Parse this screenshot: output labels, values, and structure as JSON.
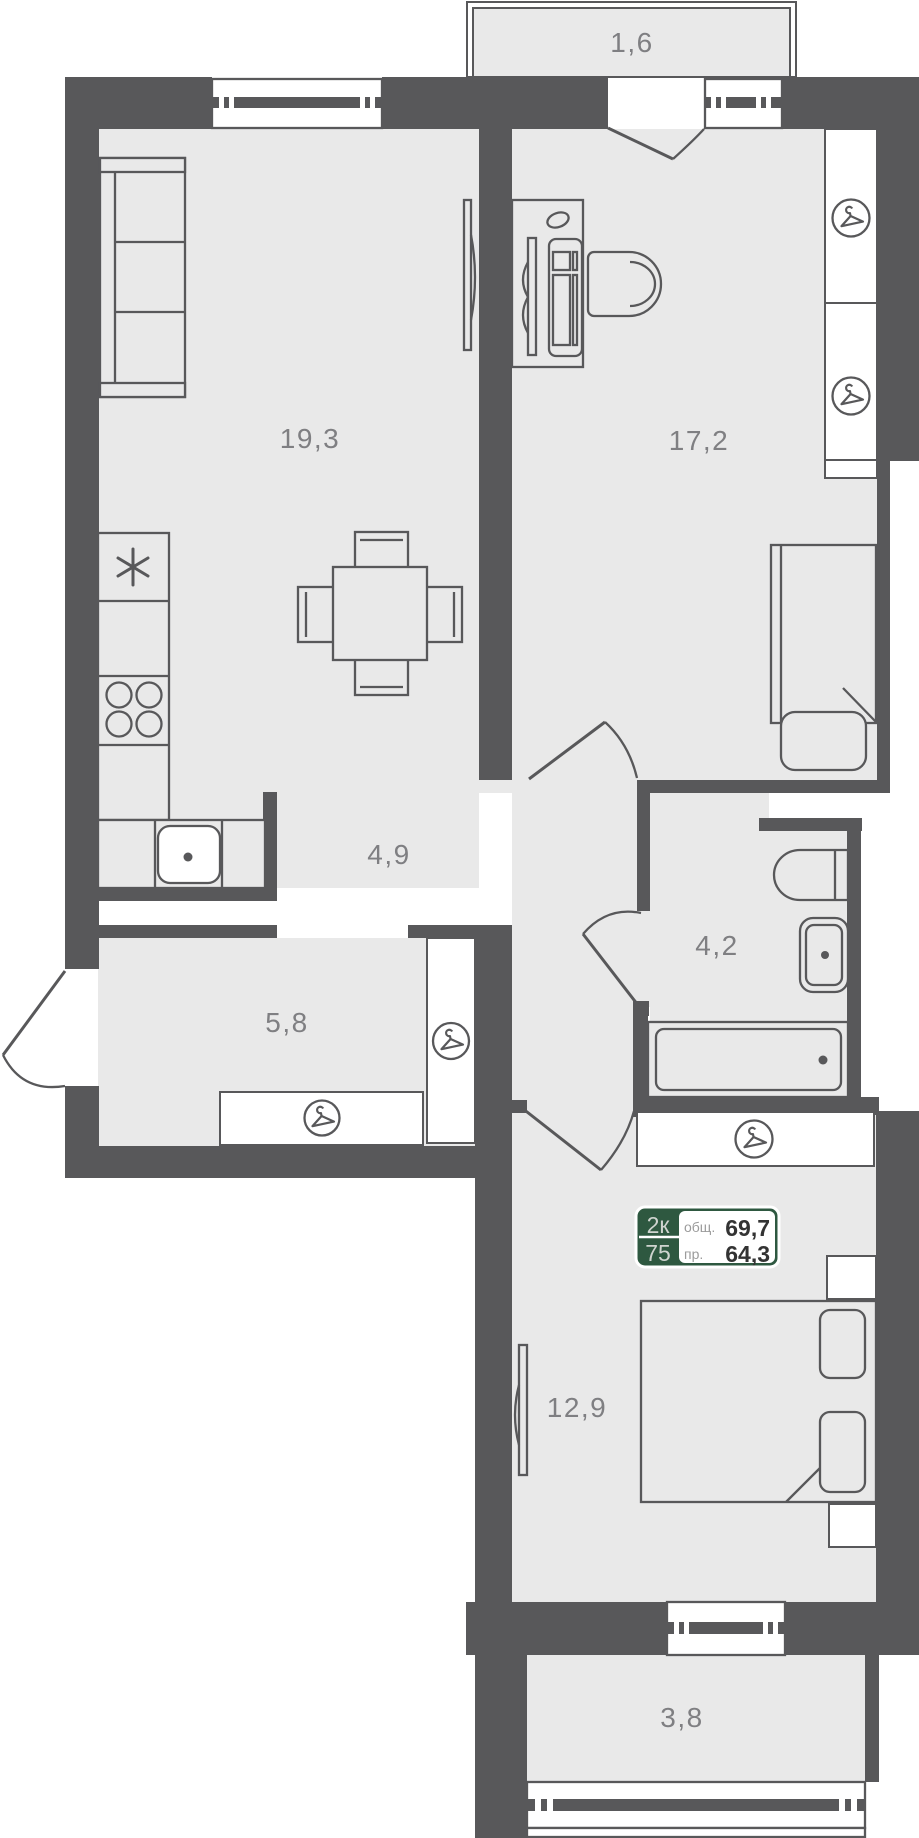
{
  "plan": {
    "type": "apartment-floor-plan",
    "rooms": [
      {
        "id": "balcony-top",
        "area_label": "1,6"
      },
      {
        "id": "kitchen-living",
        "area_label": "19,3"
      },
      {
        "id": "bedroom-right",
        "area_label": "17,2"
      },
      {
        "id": "hallway",
        "area_label": "4,9"
      },
      {
        "id": "bathroom",
        "area_label": "4,2"
      },
      {
        "id": "entry-hall",
        "area_label": "5,8"
      },
      {
        "id": "bedroom-lower",
        "area_label": "12,9"
      },
      {
        "id": "balcony-bottom",
        "area_label": "3,8"
      }
    ],
    "info_badge": {
      "rooms_count": "2к",
      "number": "75",
      "total_area_label": "общ.",
      "total_area_value": "69,7",
      "living_area_label": "пр.",
      "living_area_value": "64,3"
    },
    "icons": [
      {
        "name": "hanger-icon",
        "meaning": "wardrobe with hangers",
        "count": 5
      }
    ],
    "colors": {
      "wall": "#58585a",
      "floor": "#e9e9e9",
      "room_label": "#7f7f82",
      "badge_green": "#2e5840",
      "badge_number_text": "#333333",
      "badge_light_text": "#cfd4cf"
    }
  }
}
